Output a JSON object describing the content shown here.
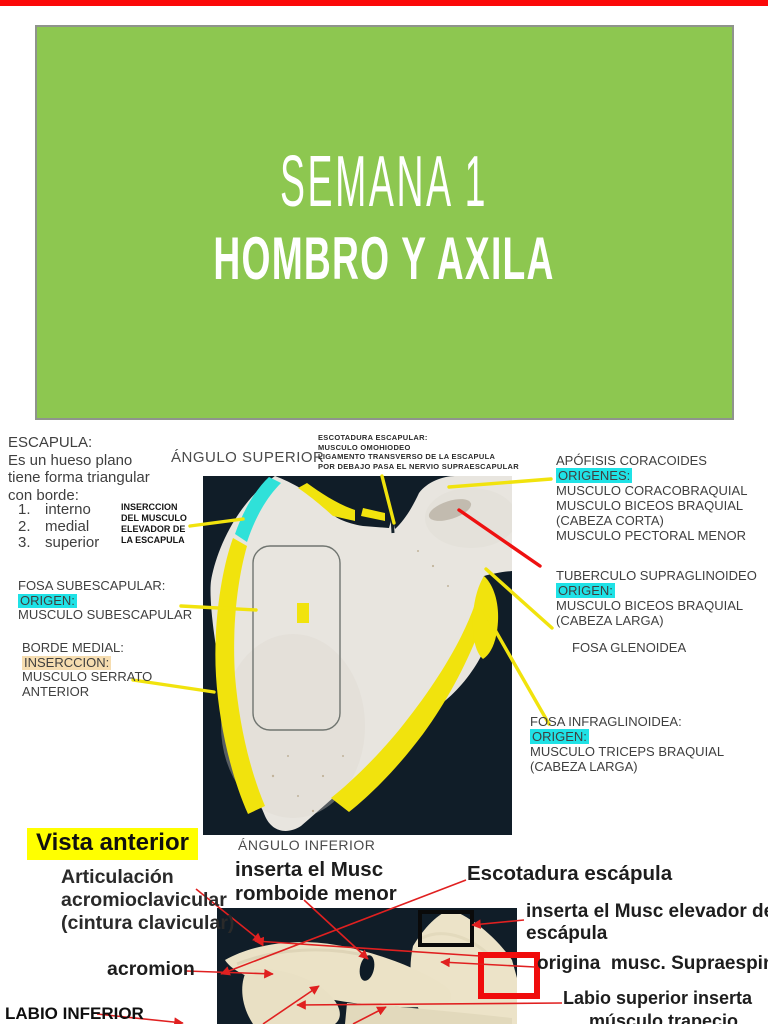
{
  "page": {
    "top_bar_color": "#fb0808",
    "background": "#ffffff"
  },
  "colors": {
    "slide_green": "#8dc750",
    "highlight_cyan": "#1fe2e6",
    "highlight_tan": "#f6ddb0",
    "highlight_yellow": "#ffff00",
    "marker_yellow": "#f1e30d",
    "marker_red": "#e81515",
    "photo_background": "#101d28",
    "bone_white": "#e8e5df",
    "bone_cream": "#ece3c8",
    "paint_cyan": "#2fe1d9"
  },
  "title_slide": {
    "line1": "SEMANA 1",
    "line2": "HOMBRO Y AXILA"
  },
  "anatomy": {
    "angulo_superior": "ÁNGULO SUPERIOR",
    "angulo_inferior": "ÁNGULO INFERIOR",
    "top_caption": {
      "l1": "ESCOTADURA ESCAPULAR:",
      "l2": "MUSCULO OMOHIODEO",
      "l3": "LIGAMENTO TRANSVERSO DE LA ESCAPULA",
      "l4": "POR DEBAJO PASA EL NERVIO SUPRAESCAPULAR"
    },
    "intro": {
      "title": "ESCAPULA:",
      "l1": "Es un hueso plano",
      "l2": "tiene forma triangular",
      "l3": "con borde:",
      "list": [
        {
          "num": "1.",
          "label": "interno"
        },
        {
          "num": "2.",
          "label": "medial"
        },
        {
          "num": "3.",
          "label": "superior"
        }
      ]
    },
    "inserccion_elevador": {
      "l1": "INSERCCION",
      "l2": "DEL MUSCULO",
      "l3": "ELEVADOR DE",
      "l4": "LA ESCAPULA"
    },
    "fosa_subescapular": {
      "title": "FOSA SUBESCAPULAR:",
      "highlight": "ORIGEN:",
      "l1": "MUSCULO SUBESCAPULAR"
    },
    "borde_medial": {
      "title": "BORDE MEDIAL:",
      "highlight": "INSERCCION:",
      "l1": "MUSCULO SERRATO",
      "l2": "ANTERIOR"
    },
    "coracoides": {
      "title": "APÓFISIS CORACOIDES",
      "highlight": "ORIGENES:",
      "l1": "MUSCULO CORACOBRAQUIAL",
      "l2": "MUSCULO BICEOS BRAQUIAL",
      "l3": "(CABEZA CORTA)",
      "l4": "MUSCULO PECTORAL MENOR"
    },
    "tuberculo": {
      "title": "TUBERCULO SUPRAGLINOIDEO",
      "highlight": "ORIGEN:",
      "l1": "MUSCULO BICEOS BRAQUIAL",
      "l2": "(CABEZA LARGA)"
    },
    "fosa_glenoidea": "FOSA GLENOIDEA",
    "fosa_infraglinoidea": {
      "title": "FOSA INFRAGLINOIDEA:",
      "highlight": "ORIGEN:",
      "l1": "MUSCULO TRICEPS BRAQUIAL",
      "l2": "(CABEZA LARGA)"
    },
    "vista_anterior": "Vista anterior",
    "articulacion": {
      "l1": "Articulación",
      "l2": "acromioclavicular",
      "l3": "(cintura clavicular)"
    },
    "inserta_romboide": {
      "l1": "inserta el Musc",
      "l2": "romboide menor"
    },
    "escotadura_escapula": "Escotadura escápula",
    "inserta_elevador": {
      "l1": "inserta el Musc elevador de la",
      "l2": "escápula"
    },
    "origina_supraespinoso": "origina  musc. Supraespinoso",
    "labio_superior": {
      "l1": "Labio superior inserta",
      "l2": "músculo trapecio"
    },
    "acromion": "acromion",
    "labio_inferior": "LABIO INFERIOR"
  }
}
